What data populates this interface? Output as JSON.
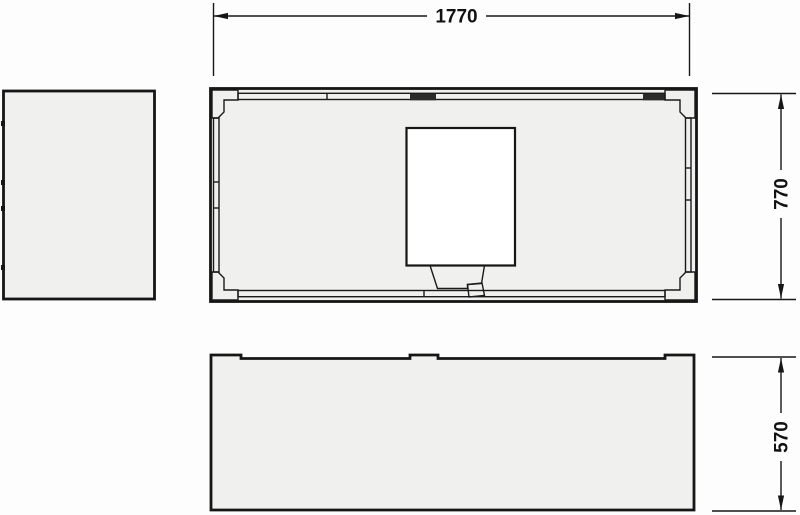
{
  "page": {
    "background": "#fdfdfd"
  },
  "drawing": {
    "line_color": "#161616",
    "panel_fill": "#f0f0ee",
    "bracket_fill": "#f8f8f7",
    "cutout_fill": "#ffffff",
    "connector_fill": "#2b2b2b",
    "dimensions": {
      "overall_width": "1770",
      "overall_depth": "770",
      "overall_height": "570"
    }
  }
}
